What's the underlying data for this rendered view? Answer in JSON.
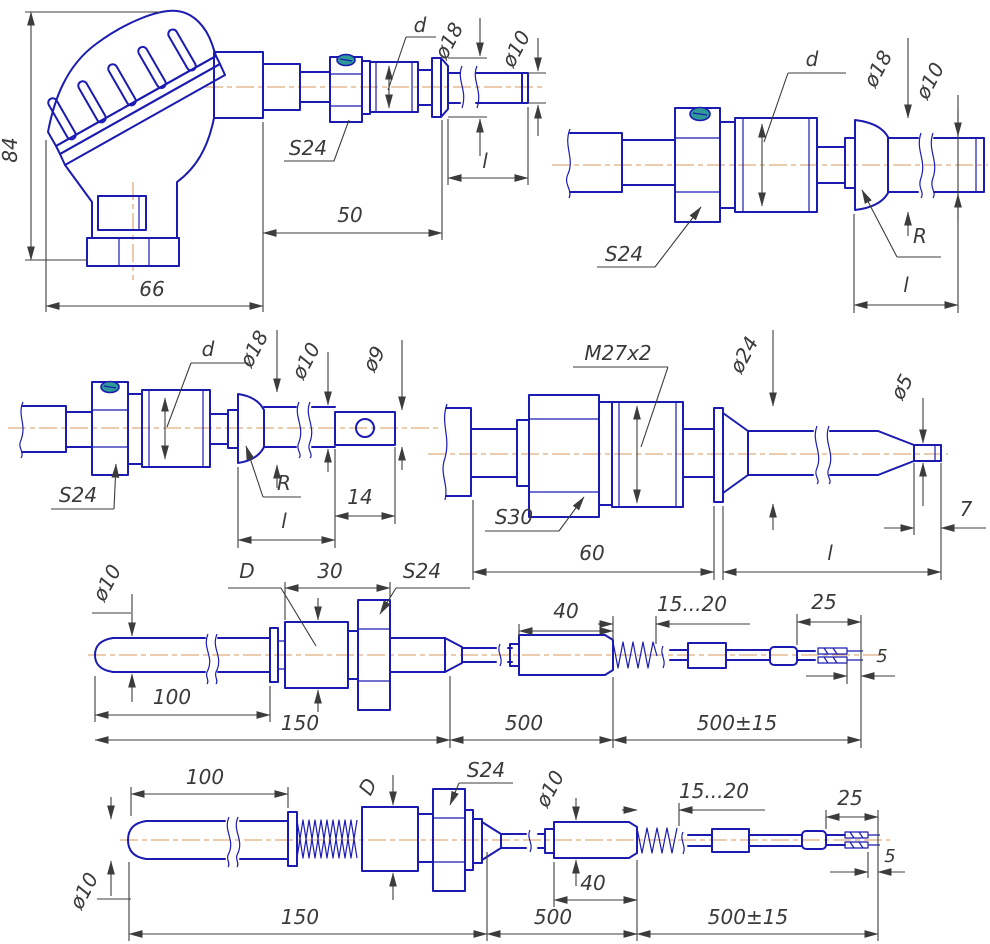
{
  "drawing": {
    "title": "Thermocouple probe mounting-variant dimensional drawings",
    "colors": {
      "line": "#1b1bb2",
      "centerline": "#dfae7e",
      "dim": "#3c3c3c",
      "text": "#3a3a3a",
      "screw": "#2e9a96",
      "bg": "#ffffff"
    },
    "views": {
      "v1": {
        "name": "sensor-with-connection-head",
        "labels": {
          "height": "84",
          "width": "66",
          "mount_len": "50",
          "imm_len": "l",
          "hex": "S24",
          "thread": "d",
          "dia18": "ø18",
          "dia10": "ø10"
        }
      },
      "v2": {
        "name": "fitting-with-spherical-nipple",
        "labels": {
          "thread": "d",
          "dia18": "ø18",
          "dia10": "ø10",
          "hex": "S24",
          "sphere": "R",
          "imm_len": "l"
        }
      },
      "v3": {
        "name": "fitting-with-lug-tip",
        "labels": {
          "thread": "d",
          "dia18": "ø18",
          "dia10": "ø10",
          "dia9": "ø9",
          "hex": "S24",
          "sphere": "R",
          "imm_len": "l",
          "lug_len": "14"
        }
      },
      "v4": {
        "name": "fitting-m27-with-taper-tip",
        "labels": {
          "thread": "M27x2",
          "dia24": "ø24",
          "dia5": "ø5",
          "hex": "S30",
          "body_len": "60",
          "imm_len": "l",
          "tip_len": "7"
        }
      },
      "v5": {
        "name": "cable-probe-smooth",
        "labels": {
          "dia10": "ø10",
          "body_dia": "D",
          "body_len": "30",
          "hex": "S24",
          "probe_len": "100",
          "mount_len": "150",
          "sleeve_len": "40",
          "flex_len": "15...20",
          "lead_len": "25",
          "mid_len": "500",
          "tail_len": "500±15",
          "strip_len": "5"
        }
      },
      "v6": {
        "name": "cable-probe-with-spring",
        "labels": {
          "probe_len": "100",
          "body_dia": "D",
          "hex": "S24",
          "probe_dia": "ø10",
          "sleeve_dia": "ø10",
          "sleeve_len": "40",
          "flex_len": "15...20",
          "lead_len": "25",
          "mount_len": "150",
          "mid_len": "500",
          "tail_len": "500±15",
          "strip_len": "5"
        }
      }
    }
  }
}
